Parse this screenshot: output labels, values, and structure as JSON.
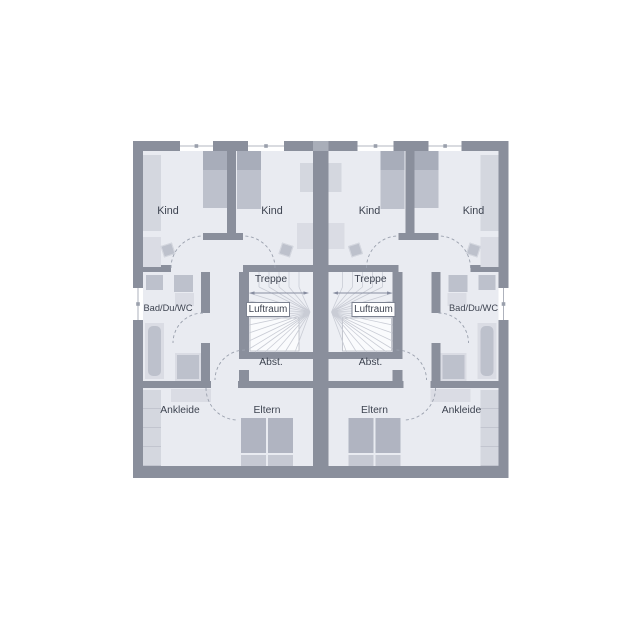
{
  "floorplan": {
    "type": "duplex-upper-floor-plan",
    "units": [
      {
        "side": "left",
        "rooms": {
          "kind_a": "Kind",
          "kind_b": "Kind",
          "treppe": "Treppe",
          "luftraum": "Luftraum",
          "bad": "Bad/Du/WC",
          "abst": "Abst.",
          "ankleide": "Ankleide",
          "eltern": "Eltern"
        }
      },
      {
        "side": "right",
        "rooms": {
          "kind_a": "Kind",
          "kind_b": "Kind",
          "treppe": "Treppe",
          "luftraum": "Luftraum",
          "bad": "Bad/Du/WC",
          "abst": "Abst.",
          "ankleide": "Ankleide",
          "eltern": "Eltern"
        }
      }
    ]
  },
  "colors": {
    "wall": "#8a8f9c",
    "wall_light": "#a9aeb9",
    "floor": "#e9ebf1",
    "stairfloor": "#edeff4",
    "furniture_light": "#d4d7df",
    "furniture_xlight": "#dadce4",
    "furniture_medium": "#bdc1cc",
    "furniture_dark": "#a8adba",
    "bed": "#b0b4c1",
    "pillow": "#c6c9d3",
    "void": "#fafbfd",
    "window": "#ffffff",
    "text": "#3d4350",
    "arc": "#9aa0ad",
    "tread": "#c9ccd5",
    "walkline": "#878da0",
    "frame": "#9aa0ac",
    "shelf_line": "#c2c5cf",
    "box_border": "#7c8290",
    "box_border_light": "#b8bcc5"
  }
}
